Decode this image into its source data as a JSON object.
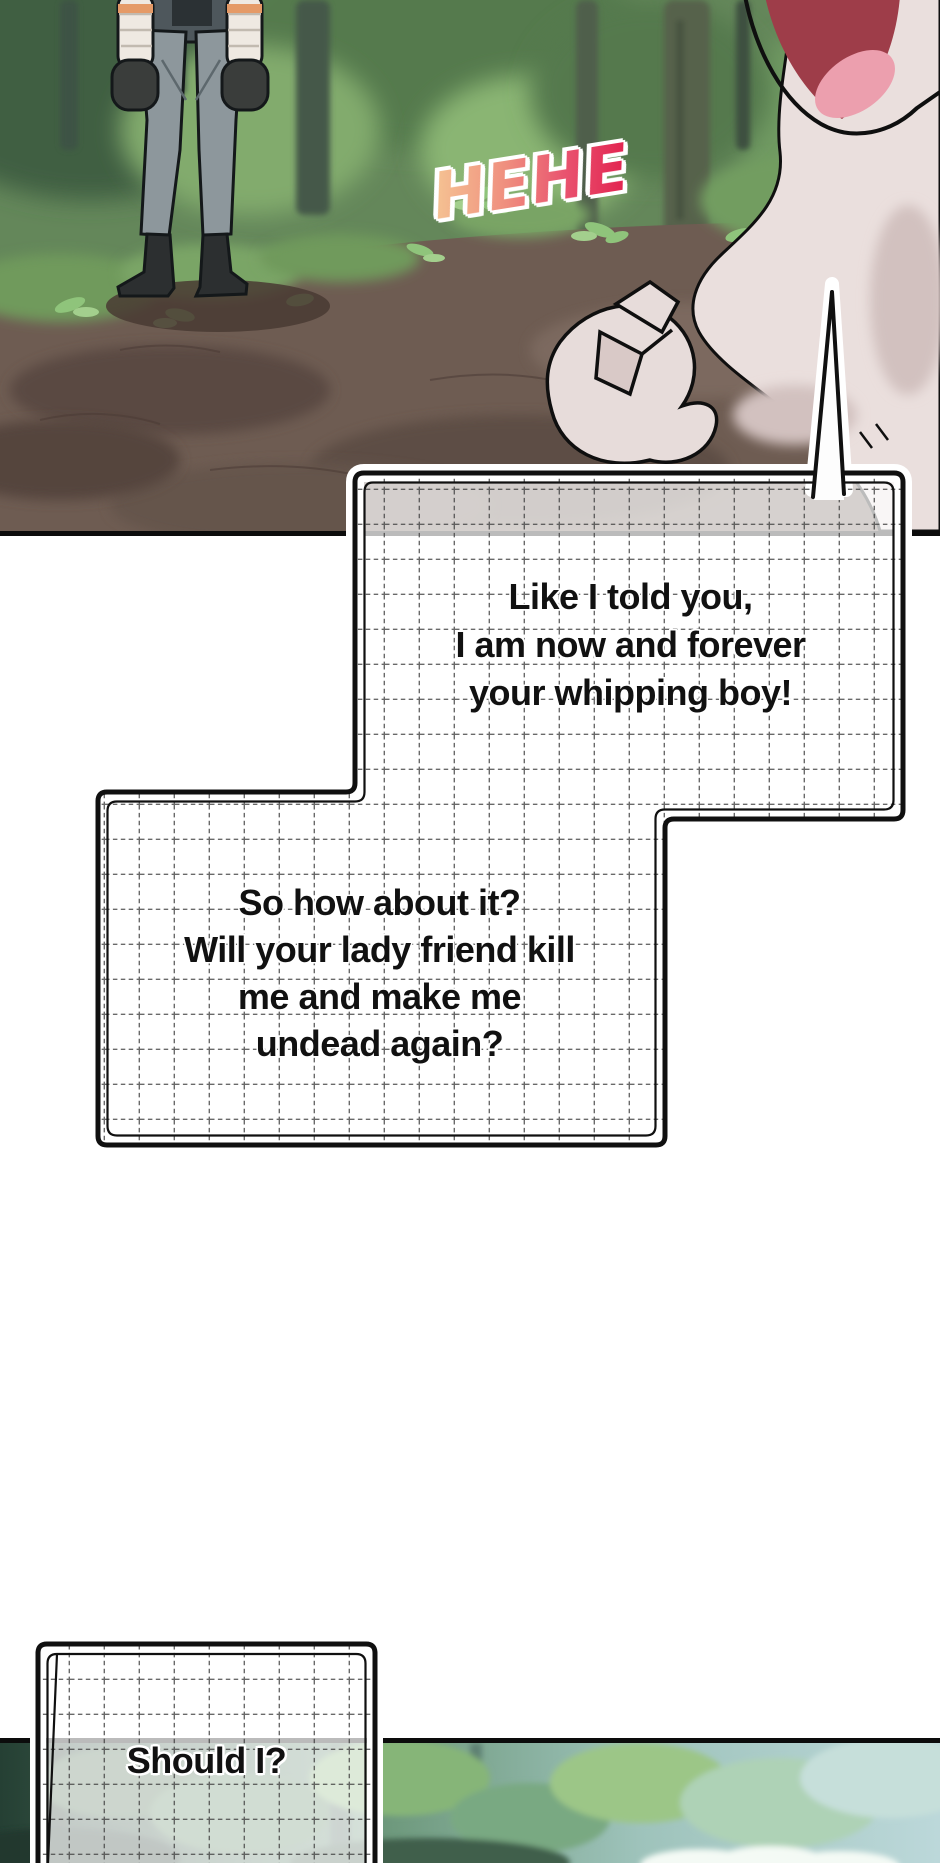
{
  "comic": {
    "sfx_hehe": "HEHE",
    "bubble1": {
      "line1": "Like I told you,",
      "line2": "I am now and forever",
      "line3": "your whipping boy!"
    },
    "bubble2": {
      "line1": "So how about it?",
      "line2": "Will your lady friend kill",
      "line3": "me and make me",
      "line4": "undead again?"
    },
    "bubble3": {
      "line1": "Should I?"
    }
  },
  "style": {
    "dialogue_color": "#111111",
    "bubble_border": "#101010",
    "bubble_fill": "#ffffff",
    "grid_line": "#444444",
    "panel_border": "#0c0c0c",
    "hehe_gradient_from": "#f5c192",
    "hehe_gradient_mid1": "#ef8e7e",
    "hehe_gradient_mid2": "#e9536f",
    "hehe_gradient_to": "#e22350",
    "forest_green": "#64875a",
    "dirt_brown": "#6e5c52",
    "mist_blue": "#bcd8da"
  }
}
